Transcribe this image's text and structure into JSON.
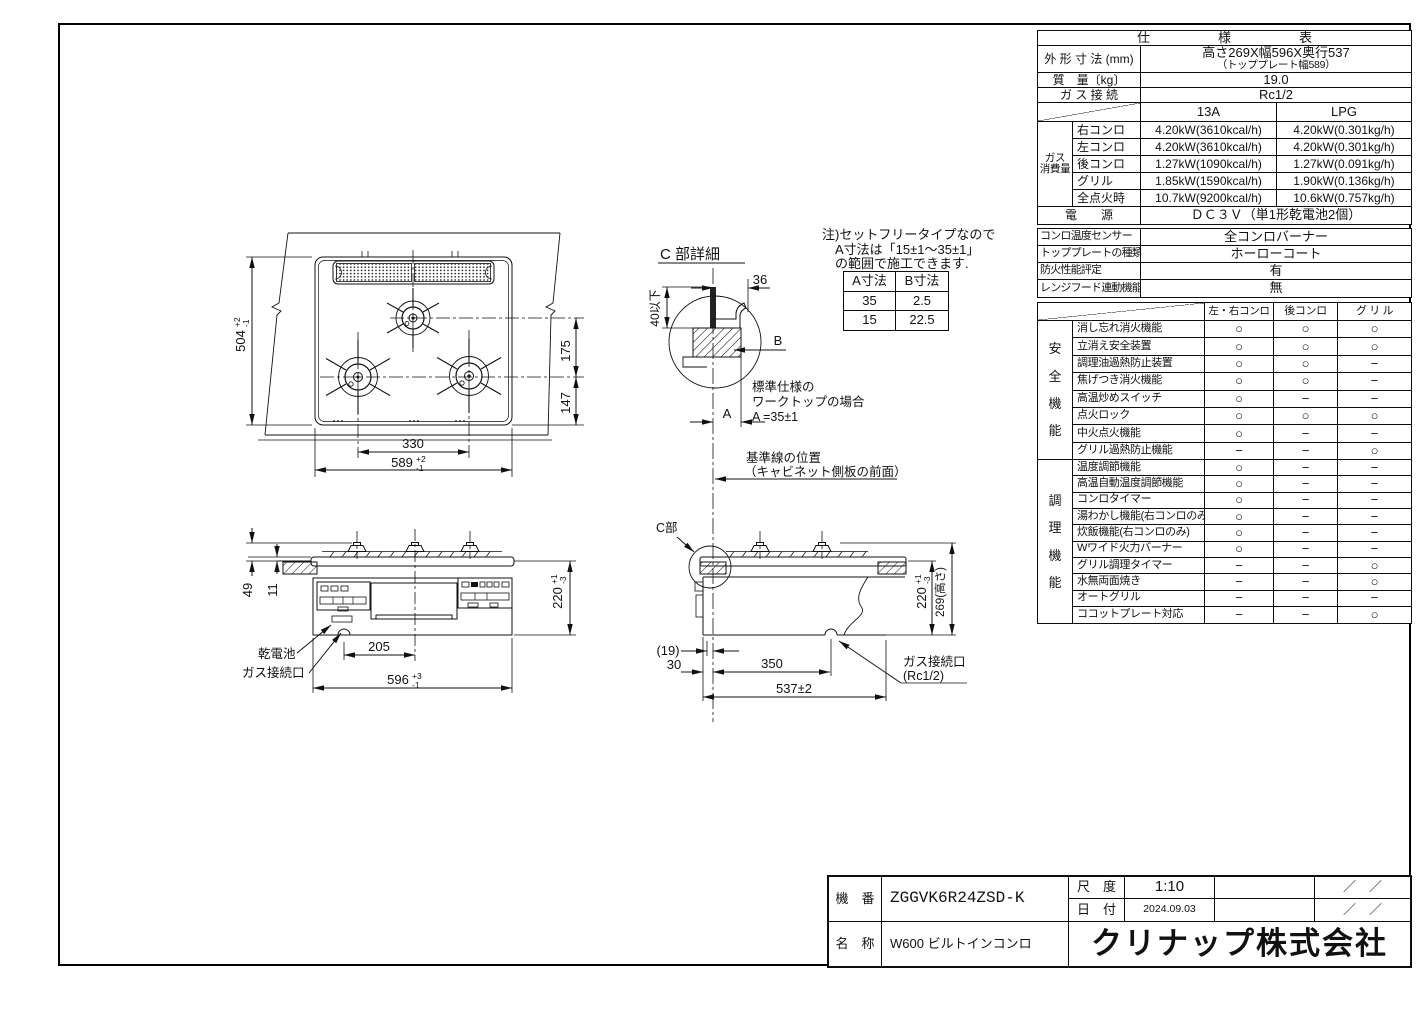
{
  "colors": {
    "paper": "#ffffff",
    "ink": "#111111"
  },
  "spec": {
    "title": "仕　　様　　表",
    "rows": {
      "dims_label": "外 形 寸 法 (mm)",
      "dims_value1": "高さ269X幅596X奥行537",
      "dims_value2": "（トッププレート幅589）",
      "mass_label": "質　量〔kg〕",
      "mass_value": "19.0",
      "gas_label": "ガ ス 接 続",
      "gas_value": "Rc1/2",
      "power_label": "電　　源",
      "power_value": "ＤＣ３Ｖ（単1形乾電池2個）"
    },
    "gas_group": "ガス\n消費量",
    "gas_cols": [
      "13A",
      "LPG"
    ],
    "gas_rows": [
      {
        "label": "右コンロ",
        "a": "4.20kW(3610kcal/h)",
        "b": "4.20kW(0.301kg/h)"
      },
      {
        "label": "左コンロ",
        "a": "4.20kW(3610kcal/h)",
        "b": "4.20kW(0.301kg/h)"
      },
      {
        "label": "後コンロ",
        "a": "1.27kW(1090kcal/h)",
        "b": "1.27kW(0.091kg/h)"
      },
      {
        "label": "グリル",
        "a": "1.85kW(1590kcal/h)",
        "b": "1.90kW(0.136kg/h)"
      },
      {
        "label": "全点火時",
        "a": "10.7kW(9200kcal/h)",
        "b": "10.6kW(0.757kg/h)"
      }
    ],
    "info_rows": [
      {
        "label": "コンロ温度センサー",
        "value": "全コンロバーナー"
      },
      {
        "label": "トッププレートの種類",
        "value": "ホーローコート"
      },
      {
        "label": "防火性能評定",
        "value": "有"
      },
      {
        "label": "レンジフード連動機能",
        "value": "無"
      }
    ],
    "matrix_cols": [
      "左・右コンロ",
      "後コンロ",
      "グ リ ル"
    ],
    "safety_group": "安\n全\n機\n能",
    "safety_rows": [
      {
        "label": "消し忘れ消火機能",
        "m": [
          "○",
          "○",
          "○"
        ]
      },
      {
        "label": "立消え安全装置",
        "m": [
          "○",
          "○",
          "○"
        ]
      },
      {
        "label": "調理油過熱防止装置",
        "m": [
          "○",
          "○",
          "−"
        ]
      },
      {
        "label": "焦げつき消火機能",
        "m": [
          "○",
          "○",
          "−"
        ]
      },
      {
        "label": "高温炒めスイッチ",
        "m": [
          "○",
          "−",
          "−"
        ]
      },
      {
        "label": "点火ロック",
        "m": [
          "○",
          "○",
          "○"
        ]
      },
      {
        "label": "中火点火機能",
        "m": [
          "○",
          "−",
          "−"
        ]
      },
      {
        "label": "グリル過熱防止機能",
        "m": [
          "−",
          "−",
          "○"
        ]
      }
    ],
    "cooking_group": "調\n理\n機\n能",
    "cooking_rows": [
      {
        "label": "温度調節機能",
        "m": [
          "○",
          "−",
          "−"
        ]
      },
      {
        "label": "高温自動温度調節機能",
        "m": [
          "○",
          "−",
          "−"
        ]
      },
      {
        "label": "コンロタイマー",
        "m": [
          "○",
          "−",
          "−"
        ]
      },
      {
        "label": "湯わかし機能(右コンロのみ)",
        "m": [
          "○",
          "−",
          "−"
        ]
      },
      {
        "label": "炊飯機能(右コンロのみ)",
        "m": [
          "○",
          "−",
          "−"
        ]
      },
      {
        "label": "Wワイド火力バーナー",
        "m": [
          "○",
          "−",
          "−"
        ]
      },
      {
        "label": "グリル調理タイマー",
        "m": [
          "−",
          "−",
          "○"
        ]
      },
      {
        "label": "水無両面焼き",
        "m": [
          "−",
          "−",
          "○"
        ]
      },
      {
        "label": "オートグリル",
        "m": [
          "−",
          "−",
          "−"
        ]
      },
      {
        "label": "ココットプレート対応",
        "m": [
          "−",
          "−",
          "○"
        ]
      }
    ]
  },
  "note": {
    "l1": "注)セットフリータイプなので",
    "l2": "A寸法は「15±1～35±1」",
    "l3": "の範囲で施工できます."
  },
  "ab_table": {
    "head": [
      "A寸法",
      "B寸法"
    ],
    "rows": [
      [
        "35",
        "2.5"
      ],
      [
        "15",
        "22.5"
      ]
    ]
  },
  "title_block": {
    "model_label": "機　番",
    "model_value": "ZGGVK6R24ZSD-K",
    "name_label": "名　称",
    "name_value": "W600 ビルトインコンロ",
    "scale_label": "尺　度",
    "scale_value": "1:10",
    "date_label": "日　付",
    "date_value": "2024.09.03",
    "slash1": "／　／",
    "slash2": "／　／",
    "company": "クリナップ株式会社"
  },
  "drawing": {
    "dim504": "504",
    "tol504p": "+2",
    "tol504m": "-1",
    "dim589": "589",
    "tol589p": "+2",
    "tol589m": "-1",
    "dim330": "330",
    "dim175": "175",
    "dim147": "147",
    "dim49": "49",
    "dim11": "11",
    "dim205": "205",
    "dim596": "596",
    "tol596p": "+3",
    "tol596m": "-1",
    "dim220f": "220",
    "tol220p": "+1",
    "tol220m": "-3",
    "dim220s": "220",
    "dim269": "269(高さ)",
    "dim19": "(19)",
    "dim30": "30",
    "dim350": "350",
    "dim537": "537±2",
    "dim36": "36",
    "dim40": "40以下",
    "lblA": "A",
    "lblB": "B",
    "detail_title": "C 部詳細",
    "c_part": "C部",
    "battery": "乾電池",
    "gas_port": "ガス接続口",
    "gas_port2a": "ガス接続口",
    "gas_port2b": "(Rc1/2)",
    "std1": "標準仕様の",
    "std2": "ワークトップの場合",
    "std3": "A =35±1",
    "ref1": "基準線の位置",
    "ref2": "（キャビネット側板の前面）"
  }
}
